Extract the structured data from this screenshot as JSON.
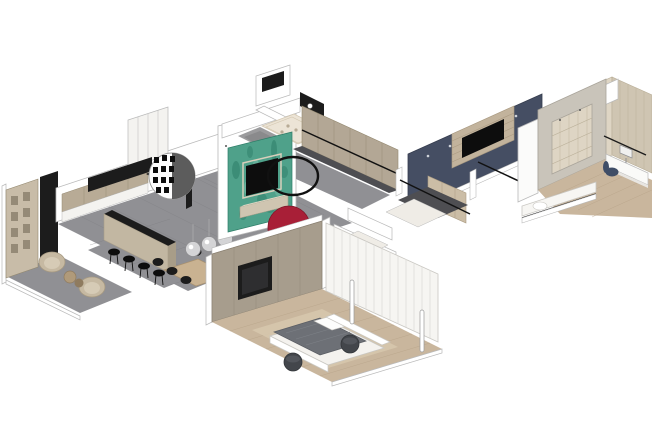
{
  "meta": {
    "title": "Isometric cutaway 3D floor plan render of an apartment with no visible text",
    "view": "axonometric cutaway, white background",
    "background": "#ffffff"
  },
  "scene": {
    "rooms": [
      {
        "name": "lounge-corner",
        "features": [
          "beige shelving accent wall",
          "black tall cabinet",
          "two beige armchairs",
          "round side tables",
          "gray tile floor"
        ]
      },
      {
        "name": "kitchen",
        "features": [
          "beige upper cabinets",
          "tall white cabinet run",
          "black suspended counter",
          "round perforated screen divider",
          "bar counter with beige front",
          "four black bar stools"
        ]
      },
      {
        "name": "dining-area",
        "features": [
          "wood dining table",
          "black chairs",
          "three chrome sphere pendant lights",
          "gray tile floor"
        ]
      },
      {
        "name": "living-tv-area",
        "features": [
          "teal patina accent wall",
          "black tv with beige frame",
          "beige media console",
          "black ring mirror",
          "red semicircular chair"
        ]
      },
      {
        "name": "bathroom-top",
        "features": [
          "cream tub wet zone",
          "gray shower cell",
          "black vanity panel",
          "white partition walls"
        ]
      },
      {
        "name": "hallway-closets",
        "features": [
          "greige wardrobe fronts",
          "black rail",
          "dark floor strip",
          "gray hall floor"
        ]
      },
      {
        "name": "master-bedroom",
        "features": [
          "taupe panel tv wall",
          "black tv",
          "wood plank floor",
          "beige rug",
          "bed with gray duvet and white platform",
          "two dark poufs",
          "white curtain wall",
          "tube floor lamps",
          "small ensuite with toilet"
        ]
      },
      {
        "name": "second-bedroom-corridor",
        "features": [
          "navy accent wall",
          "wood slat tv surround",
          "black tv",
          "wood wardrobe",
          "black rails",
          "dark floor"
        ]
      },
      {
        "name": "kids-room-study",
        "features": [
          "whitewashed wood plank walls",
          "gray portal door frame",
          "wood floor",
          "white daybed",
          "desk nook with monitor",
          "navy desk chair",
          "white wall cabinet"
        ]
      }
    ]
  },
  "colors": {
    "white": "#ffffff",
    "off_white": "#f4f3f0",
    "wall_stroke": "#b9b9b9",
    "cream": "#ece4d6",
    "cream_line": "#d3c7b0",
    "cream_floor": "#efece6",
    "floor_gray": "#909094",
    "floor_seam": "#7c7c80",
    "dark_floor": "#4e4e52",
    "charcoal": "#1c1c1c",
    "black": "#0d0d0d",
    "ink": "#111111",
    "dot_gray": "#555555",
    "teal": "#4fa18a",
    "teal_dark": "#2e7d68",
    "teal_light": "#7fc0ab",
    "red": "#a81f37",
    "red_dark": "#7e1628",
    "navy": "#454e63",
    "navy_dark": "#363d4e",
    "navy_chair": "#3f4d66",
    "greige": "#b3a795",
    "greige_dark": "#93886f",
    "taupe_wall": "#a79d8d",
    "taupe_dark": "#8a8071",
    "cabinet_beige": "#b8ab96",
    "beige_front": "#c2b7a2",
    "beige_side": "#a89d88",
    "console": "#cfc5b1",
    "console_top": "#e0d8c6",
    "frame_beige": "#d8cfbb",
    "shelf_wall": "#c8bca8",
    "shelf_niche": "#8d826f",
    "chair_beige": "#c6b9a2",
    "chair_beige_dark": "#a79a82",
    "chair_cushion": "#d6cbb6",
    "wood_table": "#c9b291",
    "wood_table_dark": "#a8916f",
    "wood_floor": "#c9b69d",
    "wood_seam": "#b5a186",
    "rug": "#d6c6ad",
    "plank_light": "#ded5c4",
    "plank_mid": "#cfc5b2",
    "plank_seam": "#b9ae97",
    "portal": "#c9c4ba",
    "portal_stroke": "#a9a49a",
    "slat_wood": "#c2b39c",
    "slat_seam": "#ab9b82",
    "duvet": "#6d7076",
    "duvet_dark": "#5a5d63",
    "duvet_fold": "#7e8288",
    "pouf": "#43464b",
    "pouf_dark": "#33363a",
    "bed_white": "#f4f2ee",
    "bed_stroke": "#c9c7c2",
    "curtain": "#f6f5f2",
    "curtain_fold": "#dddcd8",
    "metal": "#d4d4d6",
    "metal_stroke": "#8f8f92",
    "cord": "#b0b0b0",
    "shower_gray": "#9b9b9d",
    "shower_dark": "#8a8a8c",
    "tv_screen": "#2e2e30",
    "side_table": "#b09a7a",
    "side_table_dark": "#8f7b5f",
    "monitor": "#f0f0ef",
    "gray_mid": "#9a9a9a",
    "wardrobe_wood": "#cbbda6",
    "spot_white": "#cfd3da"
  }
}
